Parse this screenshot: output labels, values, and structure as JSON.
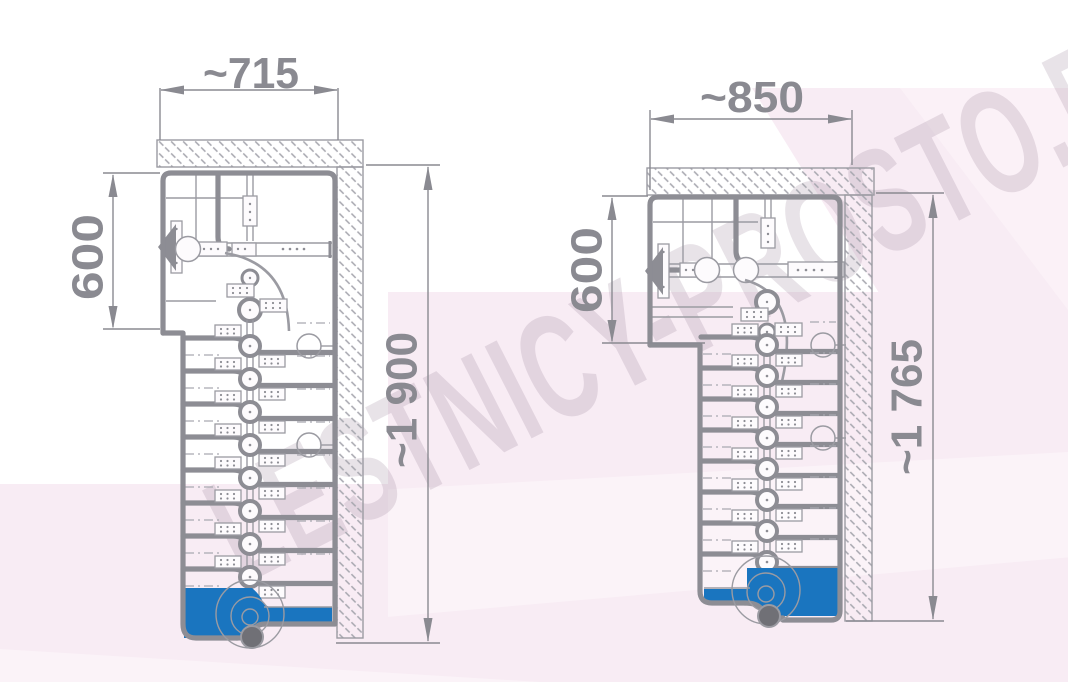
{
  "watermark": {
    "text": "LESTNICY-PROSTO.RU"
  },
  "drawings": {
    "left": {
      "width_label": "~715",
      "depth_label": "600",
      "height_label": "~1 900"
    },
    "right": {
      "width_label": "~850",
      "depth_label": "600",
      "height_label": "~1 765"
    }
  },
  "colors": {
    "blue": "#1a75bf",
    "line-thick": "#8d8d94",
    "line-thin": "#9b9ba2",
    "dim": "#8a8a91",
    "dark-pole": "#707076",
    "pink": "#f8ecf4",
    "pink-light": "#fbf3f8",
    "wm": "rgba(150,128,150,0.22)"
  }
}
